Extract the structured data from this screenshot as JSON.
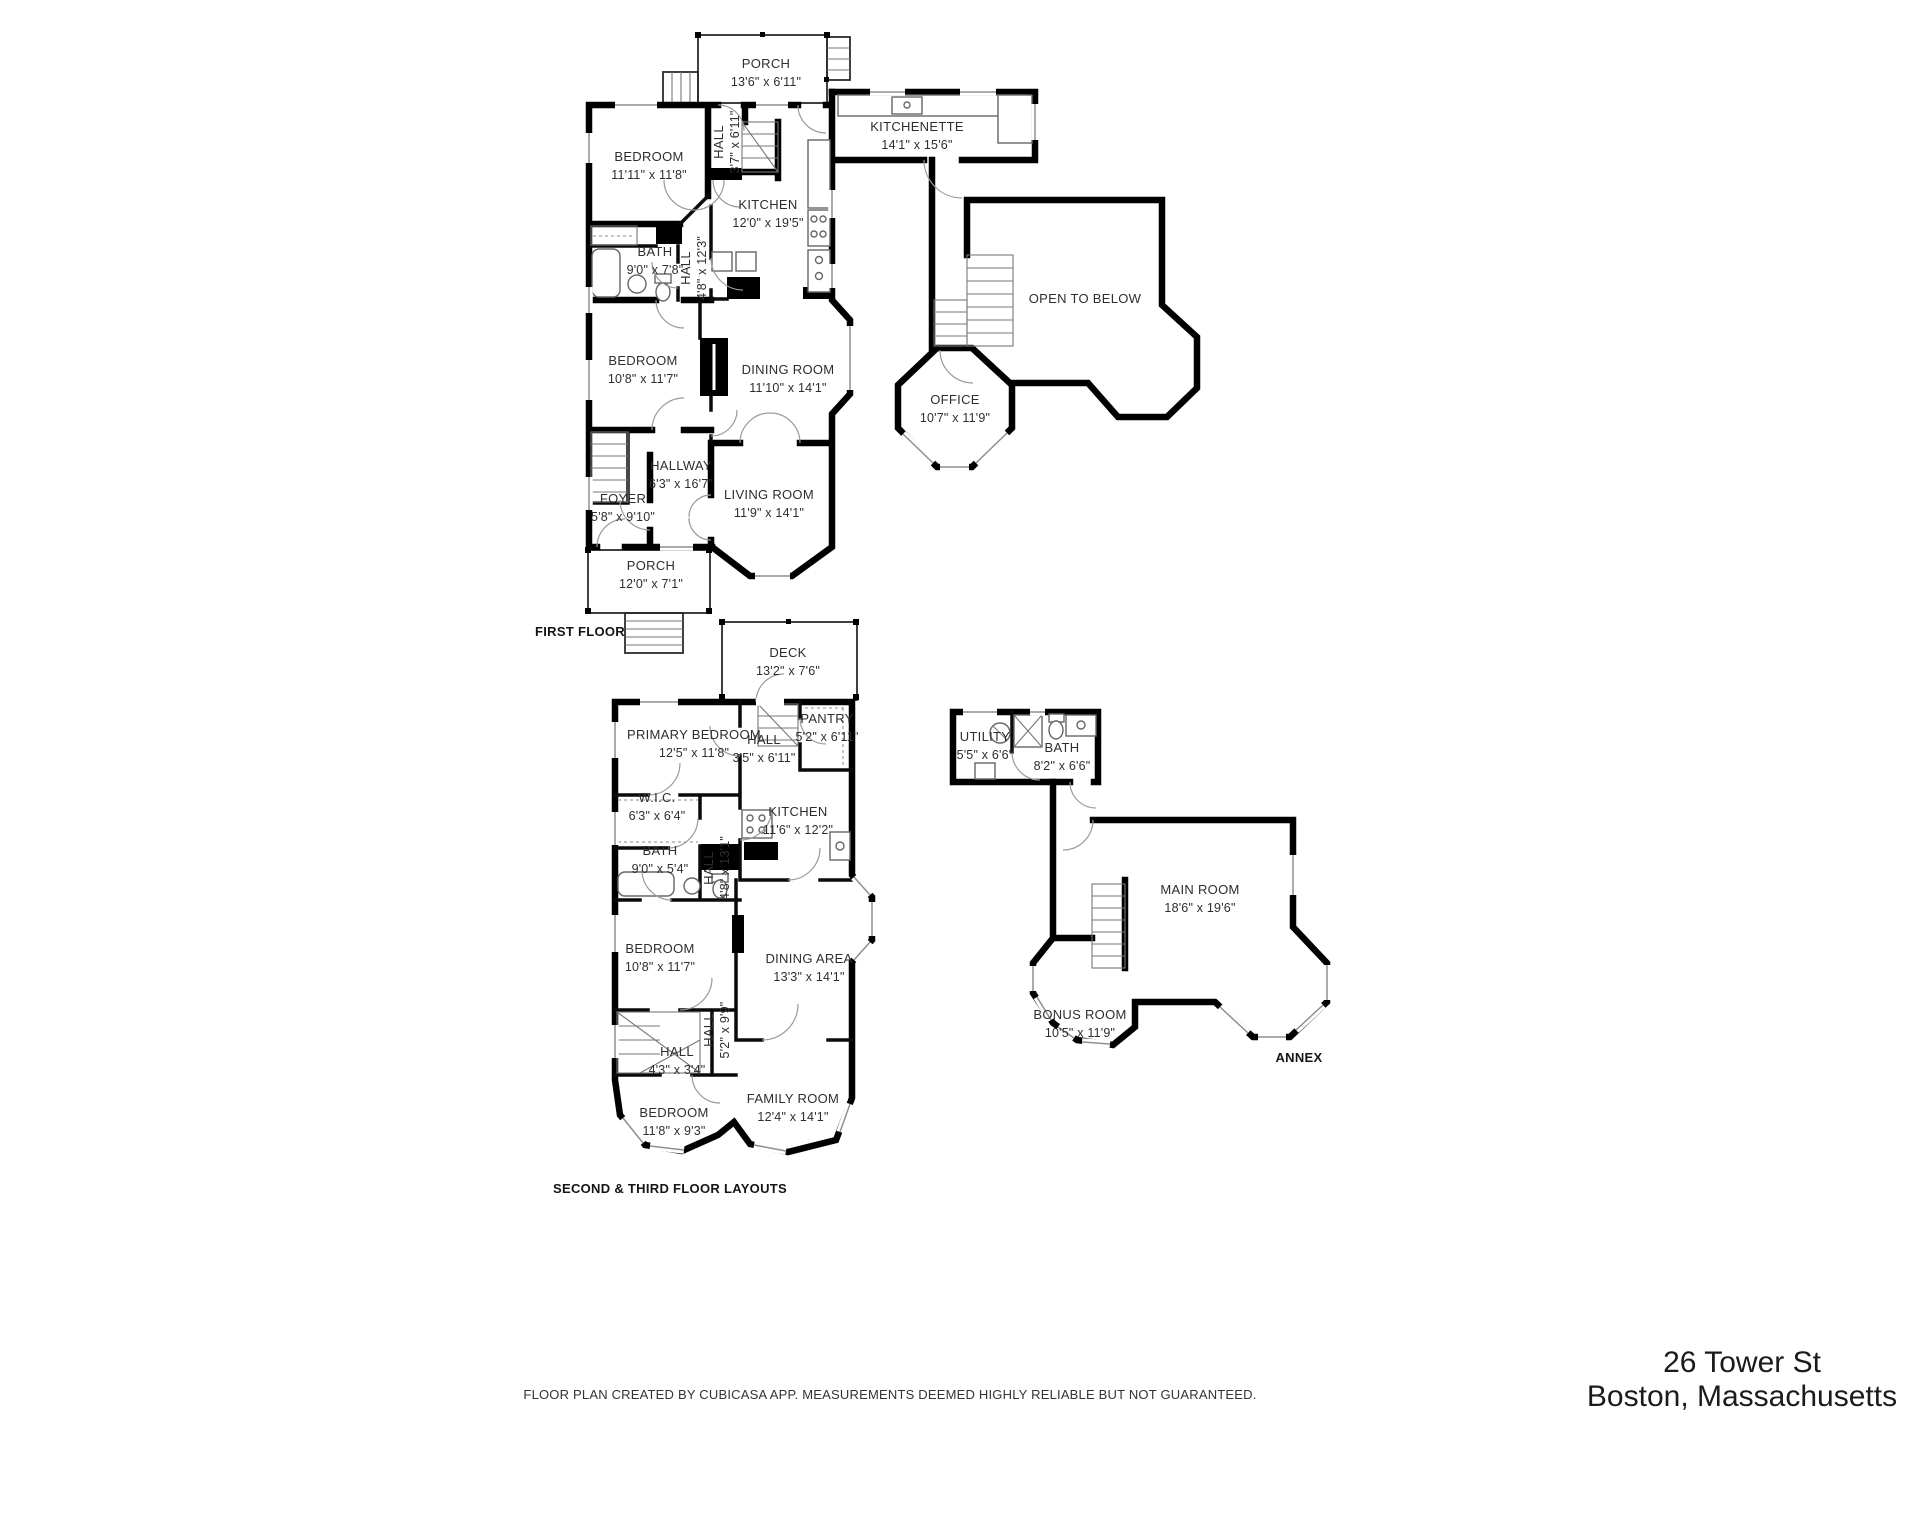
{
  "page": {
    "footer": "FLOOR PLAN CREATED BY CUBICASA APP. MEASUREMENTS DEEMED HIGHLY RELIABLE BUT NOT GUARANTEED.",
    "address_line1": "26 Tower St",
    "address_line2": "Boston, Massachusetts"
  },
  "style": {
    "wall_color": "#000000",
    "label_color": "#2e2e2e",
    "background": "#ffffff"
  },
  "plans": [
    {
      "title": "FIRST FLOOR",
      "title_pos": {
        "x": 580,
        "y": 636
      },
      "rooms": [
        {
          "label": "PORCH",
          "dims": "13'6\" x 6'11\"",
          "x": 766,
          "y": 68
        },
        {
          "label": "BEDROOM",
          "dims": "11'11\" x 11'8\"",
          "x": 649,
          "y": 161
        },
        {
          "label": "HALL",
          "dims": "3'7\" x 6'11\"",
          "x": 723,
          "y": 142,
          "rotate": true
        },
        {
          "label": "KITCHENETTE",
          "dims": "14'1\" x 15'6\"",
          "x": 917,
          "y": 131
        },
        {
          "label": "KITCHEN",
          "dims": "12'0\" x 19'5\"",
          "x": 768,
          "y": 209
        },
        {
          "label": "BATH",
          "dims": "9'0\" x 7'8\"",
          "x": 655,
          "y": 256
        },
        {
          "label": "HALL",
          "dims": "4'8\" x 12'3\"",
          "x": 690,
          "y": 268,
          "rotate": true
        },
        {
          "label": "BEDROOM",
          "dims": "10'8\" x 11'7\"",
          "x": 643,
          "y": 365
        },
        {
          "label": "DINING ROOM",
          "dims": "11'10\" x 14'1\"",
          "x": 788,
          "y": 374
        },
        {
          "label": "OPEN TO BELOW",
          "dims": "",
          "x": 1085,
          "y": 303
        },
        {
          "label": "OFFICE",
          "dims": "10'7\" x 11'9\"",
          "x": 955,
          "y": 404
        },
        {
          "label": "HALLWAY",
          "dims": "6'3\" x 16'7\"",
          "x": 681,
          "y": 470
        },
        {
          "label": "FOYER",
          "dims": "5'8\" x 9'10\"",
          "x": 623,
          "y": 503
        },
        {
          "label": "LIVING ROOM",
          "dims": "11'9\" x 14'1\"",
          "x": 769,
          "y": 499
        },
        {
          "label": "PORCH",
          "dims": "12'0\" x 7'1\"",
          "x": 651,
          "y": 570
        }
      ]
    },
    {
      "title": "SECOND & THIRD FLOOR LAYOUTS",
      "title_pos": {
        "x": 670,
        "y": 1193
      },
      "rooms": [
        {
          "label": "DECK",
          "dims": "13'2\" x 7'6\"",
          "x": 788,
          "y": 657
        },
        {
          "label": "PRIMARY BEDROOM",
          "dims": "12'5\" x 11'8\"",
          "x": 694,
          "y": 739
        },
        {
          "label": "HALL",
          "dims": "3'5\" x 6'11\"",
          "x": 764,
          "y": 744
        },
        {
          "label": "PANTRY",
          "dims": "5'2\" x 6'11\"",
          "x": 827,
          "y": 723
        },
        {
          "label": "W.I.C.",
          "dims": "6'3\" x 6'4\"",
          "x": 657,
          "y": 802
        },
        {
          "label": "BATH",
          "dims": "9'0\" x 5'4\"",
          "x": 660,
          "y": 855
        },
        {
          "label": "HALL",
          "dims": "4'8\" x 13'1\"",
          "x": 713,
          "y": 868,
          "rotate": true
        },
        {
          "label": "KITCHEN",
          "dims": "11'6\" x 12'2\"",
          "x": 798,
          "y": 816
        },
        {
          "label": "BEDROOM",
          "dims": "10'8\" x 11'7\"",
          "x": 660,
          "y": 953
        },
        {
          "label": "DINING AREA",
          "dims": "13'3\" x 14'1\"",
          "x": 809,
          "y": 963
        },
        {
          "label": "HALL",
          "dims": "5'2\" x 9'9\"",
          "x": 713,
          "y": 1030,
          "rotate": true
        },
        {
          "label": "HALL",
          "dims": "4'3\" x 3'4\"",
          "x": 677,
          "y": 1056
        },
        {
          "label": "FAMILY ROOM",
          "dims": "12'4\" x 14'1\"",
          "x": 793,
          "y": 1103
        },
        {
          "label": "BEDROOM",
          "dims": "11'8\" x 9'3\"",
          "x": 674,
          "y": 1117
        }
      ]
    },
    {
      "title": "ANNEX",
      "title_pos": {
        "x": 1299,
        "y": 1062
      },
      "rooms": [
        {
          "label": "UTILITY",
          "dims": "5'5\" x 6'6\"",
          "x": 985,
          "y": 741
        },
        {
          "label": "BATH",
          "dims": "8'2\" x 6'6\"",
          "x": 1062,
          "y": 752
        },
        {
          "label": "MAIN ROOM",
          "dims": "18'6\" x 19'6\"",
          "x": 1200,
          "y": 894
        },
        {
          "label": "BONUS ROOM",
          "dims": "10'5\" x 11'9\"",
          "x": 1080,
          "y": 1019
        }
      ]
    }
  ]
}
